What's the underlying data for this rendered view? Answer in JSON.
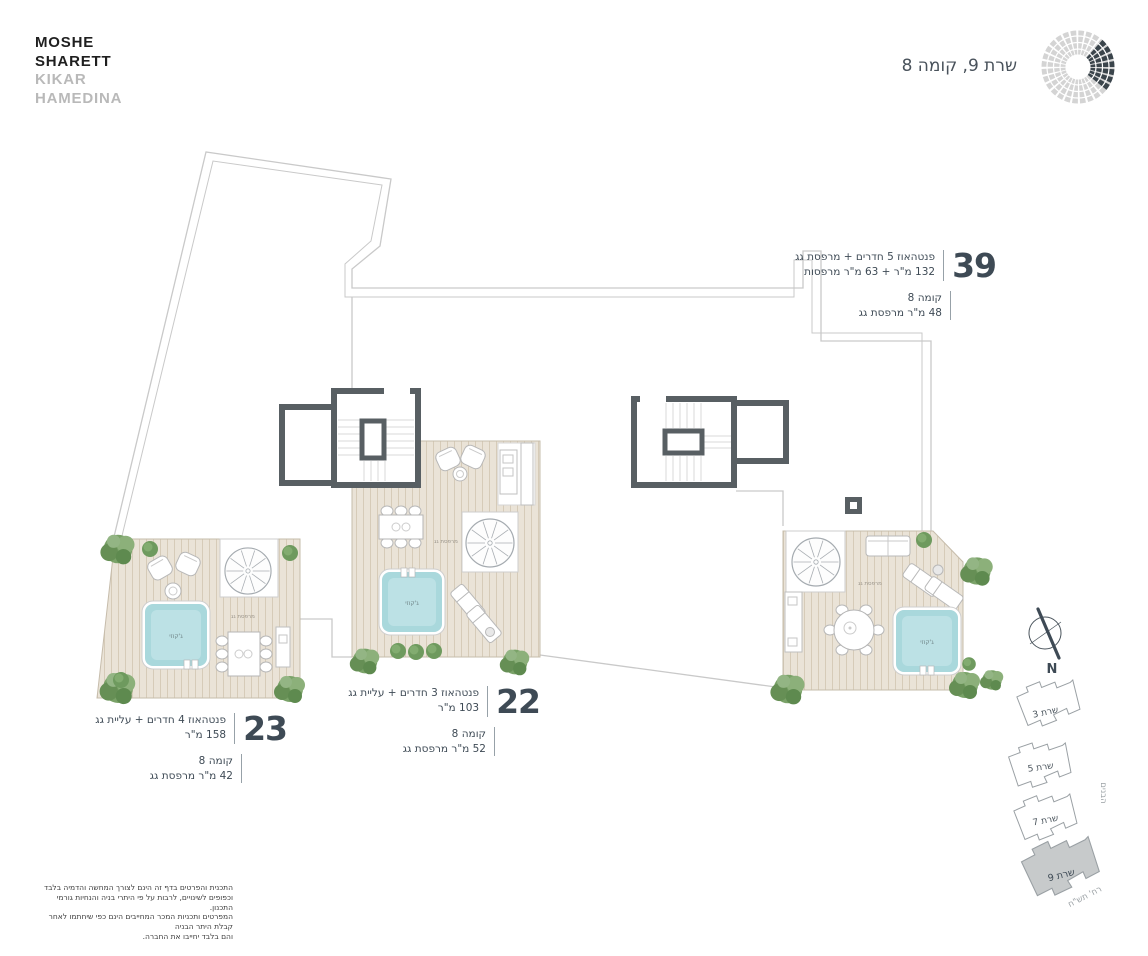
{
  "brand": {
    "line1": "MOSHE",
    "line2": "SHARETT",
    "line3": "KIKAR",
    "line4": "HAMEDINA"
  },
  "page_title": "שרת 9, קומה 8",
  "units": {
    "u39": {
      "number": "39",
      "desc": "פנטהאוז 5 חדרים + מרפסת גג",
      "area": "132 מ\"ר + 63 מ\"ר מרפסות",
      "floor": "קומה 8",
      "roof": "48 מ\"ר מרפסת גג"
    },
    "u22": {
      "number": "22",
      "desc": "פנטהאוז 3 חדרים + עליית גג",
      "area": "103 מ\"ר",
      "floor": "קומה 8",
      "roof": "52 מ\"ר מרפסת גג"
    },
    "u23": {
      "number": "23",
      "desc": "פנטהאוז 4 חדרים + עליית גג",
      "area": "158 מ\"ר",
      "floor": "קומה 8",
      "roof": "42 מ\"ר מרפסת גג"
    }
  },
  "plan_labels": {
    "roof_terrace": "מרפסת גג",
    "jacuzzi": "ג'קוזי"
  },
  "site_plan": {
    "building_3": "שרת 3",
    "building_5": "שרת 5",
    "building_7": "שרת 7",
    "building_9": "שרת 9",
    "street_side": "הבנים",
    "street_bottom": "רח' תש\"ח",
    "north": "N"
  },
  "disclaimer": {
    "line1": "התכנית והפרטים בדף זה הינם לצורך המחשה והדמיה בלבד",
    "line2": "וכפופים לשינויים, לרבות על פי היתרי בניה והנחיות גורמי התכנון.",
    "line3": "המפרטים ותכניות המכר המחייבים הינם כפי שיחתמו לאחר קבלת היתר הבניה",
    "line4": "והם בלבד יחייבו את החברה."
  },
  "colors": {
    "accent": "#3e4a55",
    "deck": "#eae3d7",
    "pool": "#a9d8dc",
    "wall": "#585f63",
    "outline": "#c9c9c9",
    "tree": "#7aa268",
    "site_highlight": "#c7cacb"
  }
}
